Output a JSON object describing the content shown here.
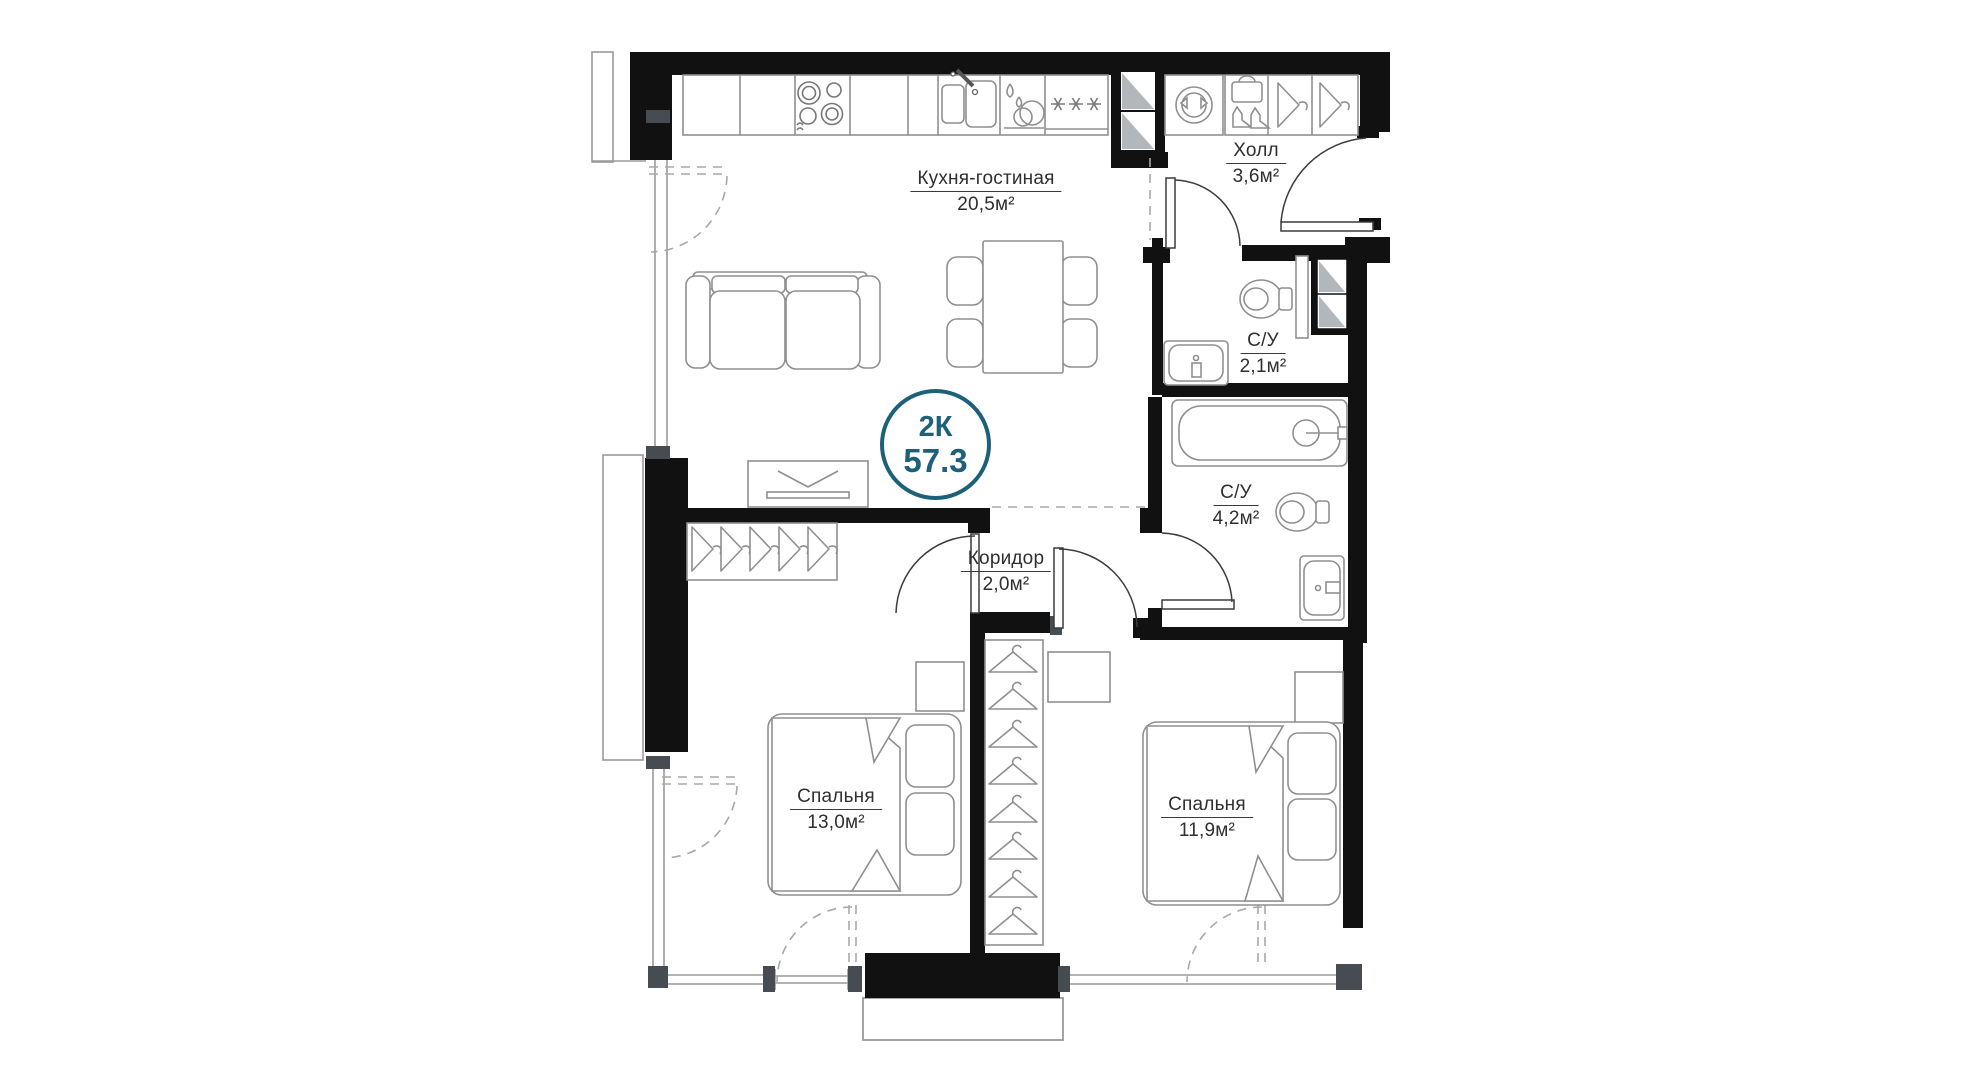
{
  "plan": {
    "badge": {
      "type": "2К",
      "area": "57.3"
    },
    "rooms": [
      {
        "id": "kitchen-living",
        "name": "Кухня-гостиная",
        "area": "20,5м²"
      },
      {
        "id": "hall",
        "name": "Холл",
        "area": "3,6м²"
      },
      {
        "id": "bath-small",
        "name": "С/У",
        "area": "2,1м²"
      },
      {
        "id": "bath-big",
        "name": "С/У",
        "area": "4,2м²"
      },
      {
        "id": "corridor",
        "name": "Коридор",
        "area": "2,0м²"
      },
      {
        "id": "bedroom-left",
        "name": "Спальня",
        "area": "13,0м²"
      },
      {
        "id": "bedroom-right",
        "name": "Спальня",
        "area": "11,9м²"
      }
    ],
    "colors": {
      "wall": "#111111",
      "line": "#8f8f8f",
      "dash": "#a8a8a8",
      "text": "#2f2f2f",
      "accent": "#1d607a",
      "shaft": "#b2b7bc"
    }
  }
}
